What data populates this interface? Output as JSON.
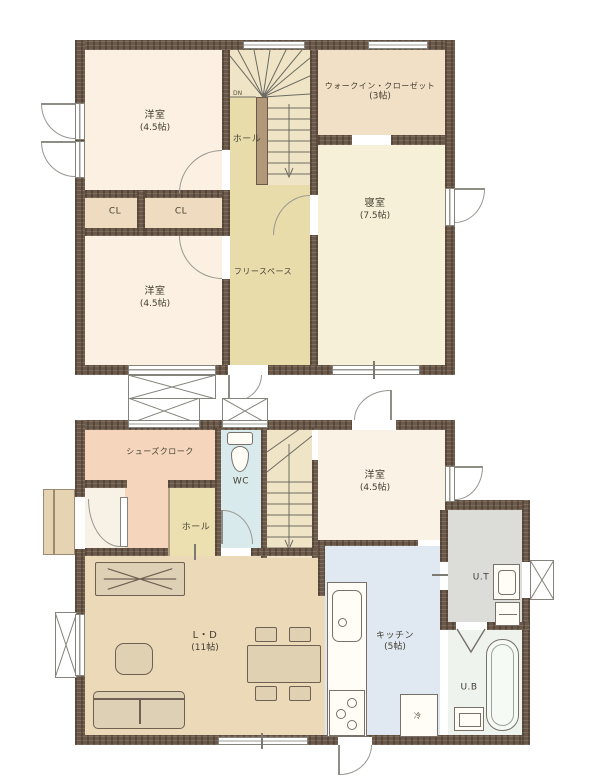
{
  "floor2": {
    "rooms": {
      "yoshitsu_a": {
        "label": "洋室",
        "size": "(4.5帖)"
      },
      "wic": {
        "label": "ウォークイン・クローゼット",
        "size": "(3帖)"
      },
      "hall": {
        "label": "ホール"
      },
      "cl_left": {
        "label": "CL"
      },
      "cl_right": {
        "label": "CL"
      },
      "shinshitsu": {
        "label": "寝室",
        "size": "(7.5帖)"
      },
      "free_space": {
        "label": "フリースペース"
      },
      "yoshitsu_b": {
        "label": "洋室",
        "size": "(4.5帖)"
      },
      "stairs_dir": {
        "label": "DN"
      }
    }
  },
  "floor1": {
    "rooms": {
      "shoes_cloak": {
        "label": "シューズクローク"
      },
      "wc": {
        "label": "WC"
      },
      "hall": {
        "label": "ホール"
      },
      "yoshitsu": {
        "label": "洋室",
        "size": "(4.5帖)"
      },
      "ut": {
        "label": "U.T"
      },
      "ld": {
        "label": "L・D",
        "size": "(11帖)"
      },
      "kitchen": {
        "label": "キッチン",
        "size": "(5帖)"
      },
      "ub": {
        "label": "U.B"
      },
      "fridge": {
        "label": "冷"
      },
      "stairs_dir": {
        "label": "UP"
      }
    }
  },
  "colors": {
    "wall": "#6a594a",
    "room_cream": "#fbf0e2",
    "room_bedroom": "#f7f0d8",
    "room_khaki": "#e9dcab",
    "room_tan": "#f1dfc4",
    "room_salmon": "#f5d6bc",
    "room_wc": "#d9eaec",
    "room_kitchen": "#e0e9f2",
    "room_ld": "#ecd9b8",
    "room_ut": "#dcdcd8",
    "room_ub": "#eef3ee",
    "stairs": "#f0e4c6"
  }
}
